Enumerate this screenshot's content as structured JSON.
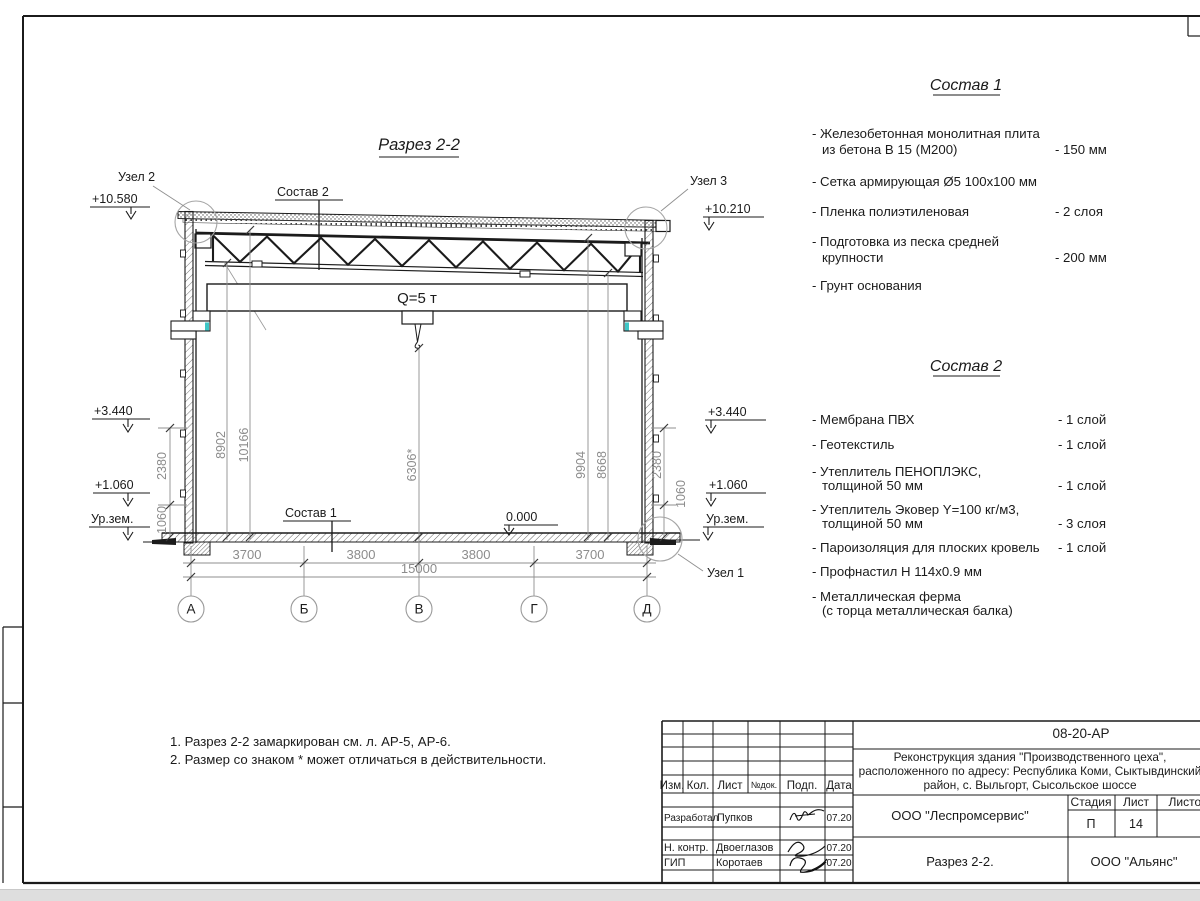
{
  "drawing": {
    "title": "Разрез 2-2",
    "crane_capacity": "Q=5 т",
    "zero_level": "0.000",
    "ground_label_left": "Ур.зем.",
    "ground_label_right": "Ур.зем.",
    "node1": "Узел 1",
    "node2": "Узел 2",
    "node3": "Узел 3",
    "leader_sostav1": "Состав 1",
    "leader_sostav2": "Состав 2",
    "elev_left_top": "+10.580",
    "elev_right_top": "+10.210",
    "elev_left_mid": "+3.440",
    "elev_right_mid": "+3.440",
    "elev_left_low": "+1.060",
    "elev_right_low": "+1.060",
    "dim_8902": "8902",
    "dim_10166": "10166",
    "dim_6306": "6306*",
    "dim_9904": "9904",
    "dim_8668": "8668",
    "dim_2380_left": "2380",
    "dim_1060_left": "1060",
    "dim_2380_right": "2380",
    "dim_1060_right": "1060",
    "span_1": "3700",
    "span_2": "3800",
    "span_3": "3800",
    "span_4": "3700",
    "total_span": "15000",
    "axis_a": "А",
    "axis_b": "Б",
    "axis_v": "В",
    "axis_g": "Г",
    "axis_d": "Д"
  },
  "sostav1": {
    "heading": "Состав 1",
    "items": [
      {
        "line1": "- Железобетонная монолитная плита",
        "line2": "из бетона В 15 (М200)",
        "value": "- 150 мм"
      },
      {
        "line1": "- Сетка армирующая Ø5 100х100 мм"
      },
      {
        "line1": "- Пленка полиэтиленовая",
        "value": "- 2 слоя"
      },
      {
        "line1": "- Подготовка из песка средней",
        "line2": "крупности",
        "value": "- 200 мм"
      },
      {
        "line1": "- Грунт основания"
      }
    ]
  },
  "sostav2": {
    "heading": "Состав 2",
    "items": [
      {
        "line1": "- Мембрана ПВХ",
        "value": "- 1 слой"
      },
      {
        "line1": "- Геотекстиль",
        "value": "- 1 слой"
      },
      {
        "line1": "- Утеплитель ПЕНОПЛЭКС,",
        "line2": "толщиной 50 мм",
        "value": "- 1 слой"
      },
      {
        "line1": "- Утеплитель Эковер Y=100 кг/м3,",
        "line2": "толщиной 50 мм",
        "value": "- 3 слоя"
      },
      {
        "line1": "- Пароизоляция для плоских кровель",
        "value": "- 1 слой"
      },
      {
        "line1": "- Профнастил Н 114х0.9 мм"
      },
      {
        "line1": "- Металлическая ферма",
        "line2": "(с торца металлическая балка)"
      }
    ]
  },
  "notes": {
    "line1": "1. Разрез 2-2 замаркирован см. л. АР-5, АР-6.",
    "line2": "2. Размер со знаком * может отличаться в действительности."
  },
  "titleblock": {
    "doc_number": "08-20-АР",
    "project_name_line1": "Реконструкция здания \"Производственного цеха\",",
    "project_name_line2": "расположенного по адресу: Республика Коми, Сыктывдинский",
    "project_name_line3": "район, с. Выльгорт, Сысольское шоссе",
    "design_org": "ООО \"Леспромсервис\"",
    "sheet_name": "Разрез 2-2.",
    "customer_org": "ООО \"Альянс\"",
    "col_izm": "Изм.",
    "col_kol": "Кол.",
    "col_list": "Лист",
    "col_ndok": "№док.",
    "col_podp": "Подп.",
    "col_data": "Дата",
    "stage_label": "Стадия",
    "list_label": "Лист",
    "listov_label": "Листов",
    "stage_value": "П",
    "list_value": "14",
    "row1_role": "Разработал",
    "row1_name": "Пупков",
    "row1_date": "07.20",
    "row2_role": "Н. контр.",
    "row2_name": "Двоеглазов",
    "row2_date": "07.20",
    "row3_role": "ГИП",
    "row3_name": "Коротаев",
    "row3_date": "07.20"
  }
}
